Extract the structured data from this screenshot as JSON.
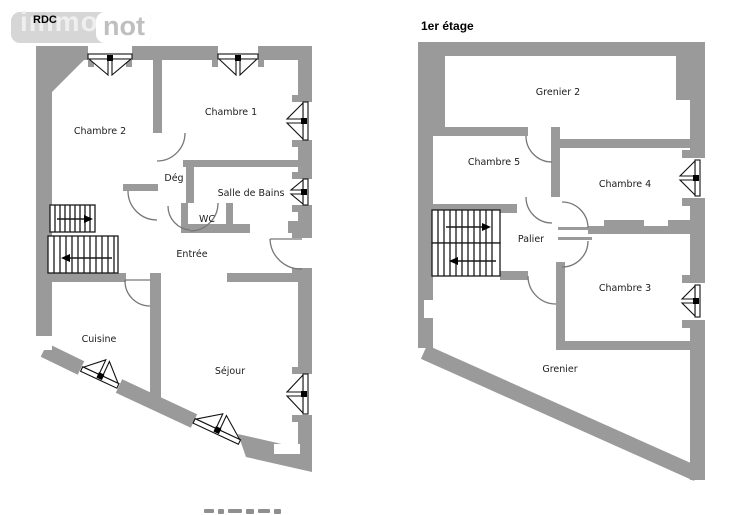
{
  "logo": {
    "text_left": "immo",
    "text_right": "not"
  },
  "plans": {
    "rdc": {
      "title": "RDC",
      "rooms": [
        "Chambre 2",
        "Chambre 1",
        "Dég",
        "Salle de Bains",
        "WC",
        "Entrée",
        "Cuisine",
        "Séjour"
      ]
    },
    "etage1": {
      "title": "1er étage",
      "rooms": [
        "Grenier 2",
        "Chambre 5",
        "Chambre 4",
        "Palier",
        "Chambre 3",
        "Grenier"
      ]
    }
  },
  "colors": {
    "wall_gray": "#9a9a9a",
    "logo_gray": "#d6d6d6",
    "logo_text_gray": "#bfbfbf",
    "label_ink": "#1c1c1c",
    "door_arc": "#777777",
    "window_line": "#111111"
  }
}
